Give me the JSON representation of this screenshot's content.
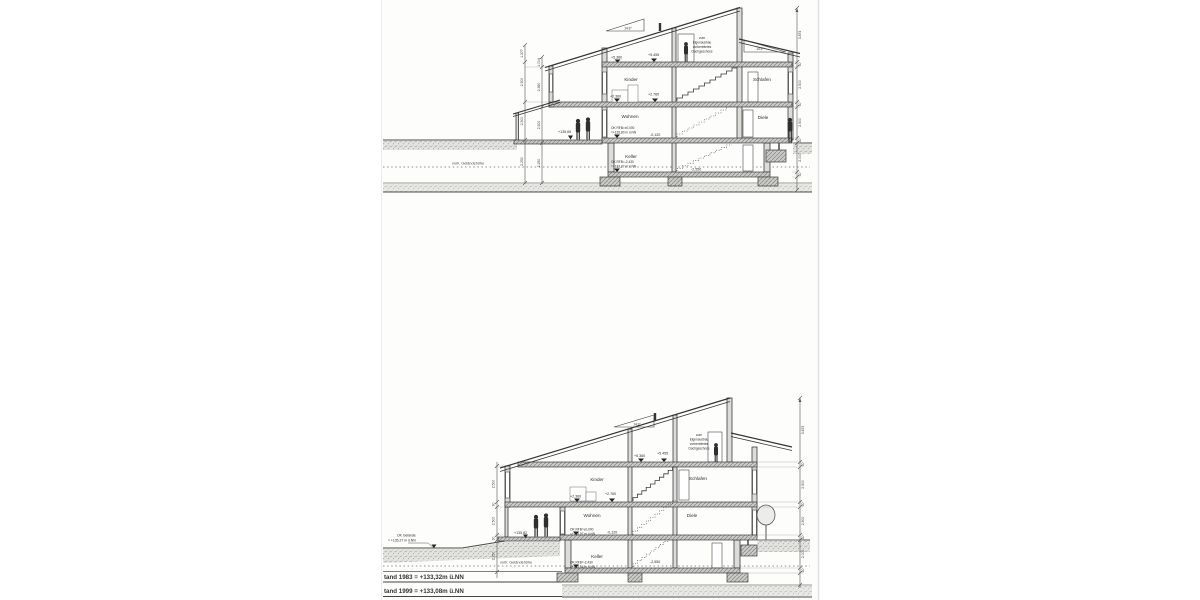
{
  "scan": {
    "upper": {
      "pitch_left": "14.9°",
      "pitch_right": "14.9°",
      "attic_note": [
        "zum",
        "Eigenausbau",
        "vorbereitetes",
        "Dachgeschoss"
      ],
      "levels": {
        "attic_left": "+5.360",
        "attic_right": "+5.455",
        "upper_left": "+2.360",
        "upper_right": "+2.760",
        "ground_ok1": "OK RFB=±0,000",
        "ground_ok2": "=+135,80 m ü.NN",
        "ground_rel": "-0,120",
        "terrace": "+135,65",
        "basement_ok1": "OK RFB=-2,430",
        "basement_ok2": "=+133,37 m ü.NN",
        "basement_rel": "-2,550"
      },
      "rooms": {
        "kinder": "Kinder",
        "schlafen": "Schlafen",
        "wohnen": "Wohnen",
        "diele": "Diele",
        "keller": "Keller"
      },
      "terrain_label": "vorh. Geländehöhe",
      "dims_left_outer": [
        "1.377",
        "2.500",
        "2.500",
        "2.250"
      ],
      "dims_left_inner": [
        "1.004",
        "2.360",
        "2.500",
        "2.250"
      ],
      "dims_right": [
        "3.873",
        "30",
        "2.500",
        "30",
        "2.500",
        "30",
        "2.000",
        "30"
      ]
    },
    "lower": {
      "pitch_left": "14.9°",
      "attic_note": [
        "zum",
        "Eigenausbau",
        "vorbereitetes",
        "Dachgeschoss"
      ],
      "levels": {
        "attic_left": "+5.360",
        "attic_right": "+5.455",
        "upper_left": "+2.360",
        "upper_right": "+2.760",
        "ground_ok1": "OK RFB=±0,000",
        "ground_ok2": "=+135,97 m ü.NN",
        "ground_rel": "-0,120",
        "terrace": "+135,82",
        "basement_ok1": "OK RFB=-2,430",
        "basement_ok2": "=+133,54 m ü.NN",
        "basement_rel": "-2,550"
      },
      "rooms": {
        "kinder": "Kinder",
        "schlafen": "Schlafen",
        "wohnen": "Wohnen",
        "diele": "Diele",
        "keller": "Keller"
      },
      "terrain_label": "vorh. Geländehöhe",
      "grade_label1": "OK Gelände",
      "grade_label2": "= +135,27 m ü.NN",
      "water_1983": "tand 1983 = +133,32m ü.NN",
      "water_1999": "tand 1999 = +133,08m ü.NN",
      "dims_left": [
        "2.500",
        "30",
        "2.500",
        "30",
        "2.250"
      ],
      "dims_right": [
        "3.873",
        "30",
        "2.500",
        "30",
        "2.500",
        "30",
        "2.000",
        "30"
      ]
    }
  }
}
